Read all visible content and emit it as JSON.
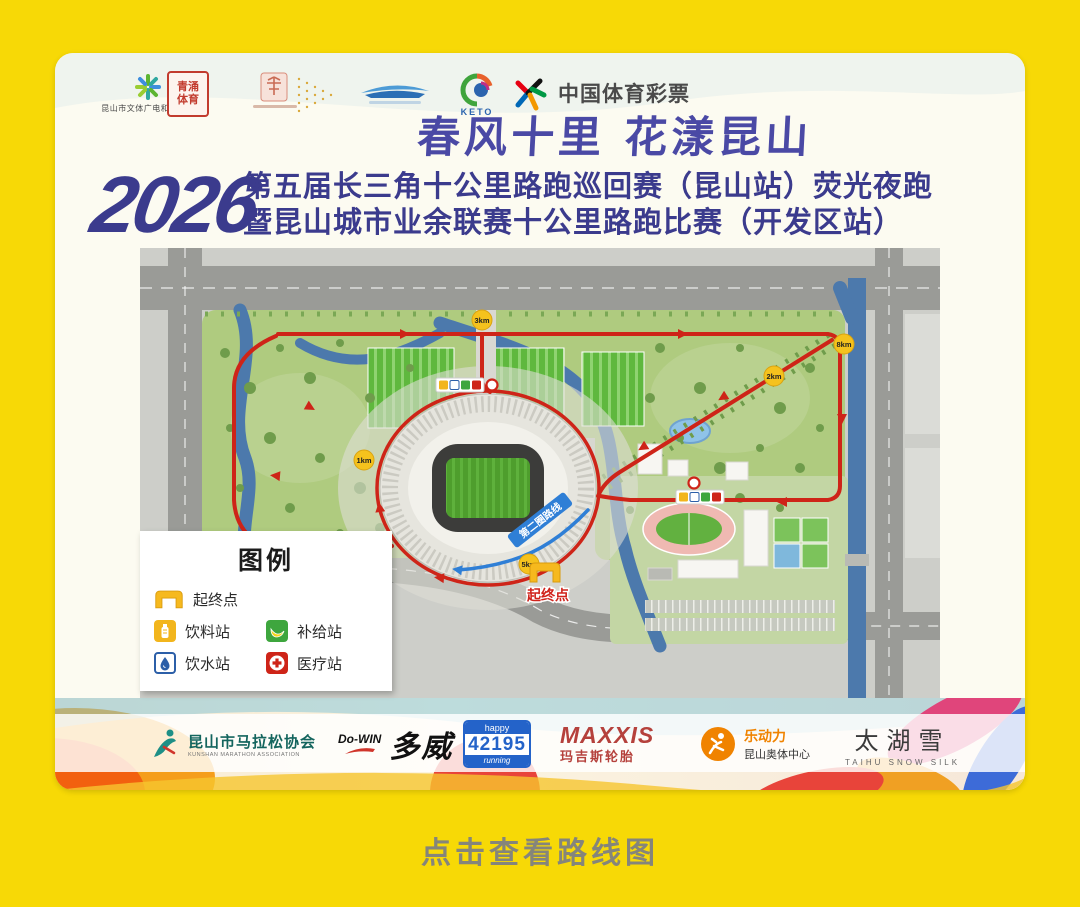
{
  "colors": {
    "background": "#F7D906",
    "title_navy": "#3B3B8D",
    "slogan_purple": "#4A49A5",
    "route_red": "#CE2418",
    "marker_yellow": "#F5C21D",
    "second_lap_blue": "#2F7FD6"
  },
  "header": {
    "logos": [
      {
        "id": "kunshan-culture-bureau",
        "label": "昆山市文体广电和旅游局"
      },
      {
        "id": "qingyong-sports-seal",
        "label": "青涌体育"
      },
      {
        "id": "suzhou-media-seal",
        "label": ""
      },
      {
        "id": "development-zone-boat",
        "label": ""
      },
      {
        "id": "keto",
        "label": "KETO"
      },
      {
        "id": "china-sports-lottery",
        "label": "中国体育彩票"
      }
    ]
  },
  "title": {
    "slogan": "春风十里 花漾昆山",
    "year": "2026",
    "line1": "第五届长三角十公里路跑巡回赛（昆山站）荧光夜跑",
    "line2": "暨昆山城市业余联赛十公里路跑比赛（开发区站）"
  },
  "map": {
    "start_finish": "起终点",
    "second_lap": "第二圈路线",
    "km_markers": [
      {
        "label": "1km"
      },
      {
        "label": "2km"
      },
      {
        "label": "3km"
      },
      {
        "label": "5km"
      },
      {
        "label": "8km"
      }
    ]
  },
  "legend": {
    "title": "图例",
    "start": "起终点",
    "drink": "饮料站",
    "supply": "补给站",
    "water": "饮水站",
    "medical": "医疗站"
  },
  "sponsors": {
    "association": {
      "cn": "昆山市马拉松协会",
      "en": "KUNSHAN MARATHON ASSOCIATION"
    },
    "dowin": {
      "latin": "Do-WIN",
      "cn": "多威"
    },
    "happy42195": {
      "top": "happy",
      "number": "42195",
      "bottom": "running"
    },
    "maxxis": {
      "latin": "MAXXIS",
      "cn": "玛吉斯轮胎"
    },
    "ledongli": {
      "cn": "乐动力",
      "sub": "昆山奥体中心"
    },
    "taihusnow": {
      "cn": "太湖雪",
      "en": "TAIHU SNOW SILK"
    }
  },
  "footer": {
    "caption": "点击查看路线图"
  }
}
